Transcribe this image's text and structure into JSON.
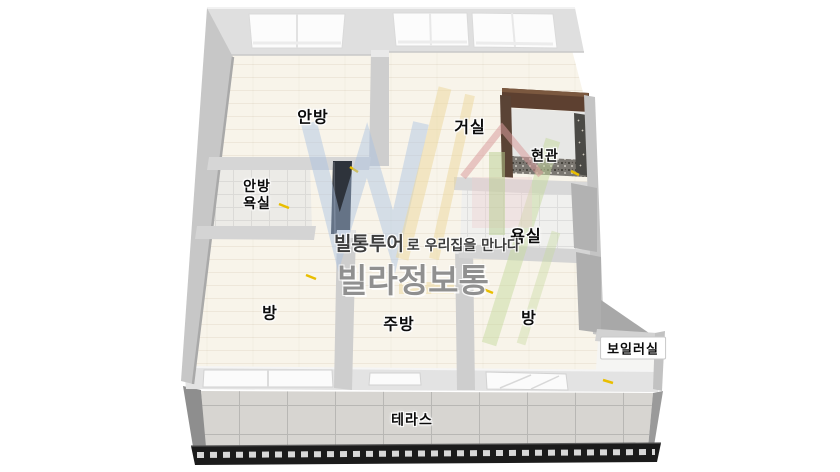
{
  "floorplan": {
    "labels": {
      "anbang": "안방",
      "geosil": "거실",
      "hyeongwan": "현관",
      "anbang_yoksil_line1": "안방",
      "anbang_yoksil_line2": "욕실",
      "yoksil": "욕실",
      "bang_left": "방",
      "jubang": "주방",
      "bang_right": "방",
      "boiler": "보일러실",
      "terrace": "테라스"
    },
    "watermark": {
      "tagline_strong": "빌통투어",
      "tagline_rest": "로 우리집을 만나다",
      "brand": "빌라정보통"
    },
    "colors": {
      "floor_wood": "#f8f4ea",
      "wall_gray": "#cecece",
      "wall_shadow": "#a9a9a9",
      "entrance_accent_brown": "#5d4030",
      "entrance_terrazzo": "#7b7771",
      "terrace_tile": "#d7d5d1",
      "railing_black": "#1b1b1b",
      "door_indicator_yellow": "#e9be00",
      "watermark_blue": "#a9c0e2",
      "watermark_yellow": "#edd89c",
      "watermark_green": "#c6da9e",
      "watermark_pink": "#edd0d0"
    }
  }
}
